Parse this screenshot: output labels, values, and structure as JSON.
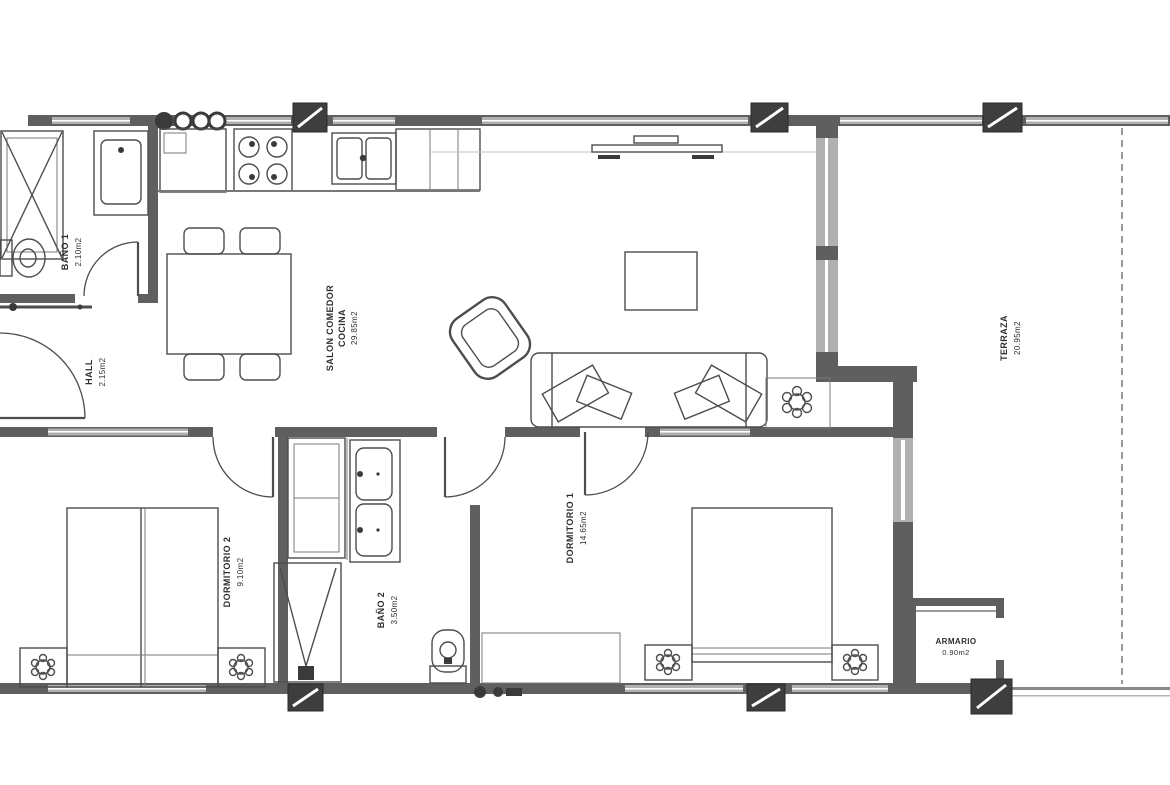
{
  "floor_plan": {
    "rooms": [
      {
        "name": "BAÑO 1",
        "area": "2.10m2"
      },
      {
        "name": "HALL",
        "area": "2.15m2"
      },
      {
        "name": "SALON COMEDOR",
        "name_line2": "COCINA",
        "area": "29.85m2"
      },
      {
        "name": "DORMITORIO 2",
        "area": "9.10m2"
      },
      {
        "name": "BAÑO 2",
        "area": "3.50m2"
      },
      {
        "name": "DORMITORIO 1",
        "area": "14.65m2"
      },
      {
        "name": "TERRAZA",
        "area": "20.95m2"
      },
      {
        "name": "ARMARIO",
        "area": "0.90m2"
      }
    ],
    "furniture_icons": [
      "shower",
      "washbasin",
      "toilet",
      "radiator",
      "hood-vent",
      "fridge",
      "stove-burners",
      "kitchen-sink",
      "counter",
      "dining-table",
      "chair",
      "tv",
      "armchair",
      "sofa",
      "coffee-table",
      "plant",
      "twin-beds",
      "double-bed",
      "nightstand",
      "lamp",
      "wardrobe",
      "double-washbasin",
      "dresser",
      "column-pillar"
    ],
    "colors": {
      "background": "#ffffff",
      "wall": "#5f5f5f",
      "window_fill": "#b0b0b0",
      "line": "#4d4d4d",
      "pillar": "#3e3e3e",
      "text": "#2e2e2e"
    }
  }
}
